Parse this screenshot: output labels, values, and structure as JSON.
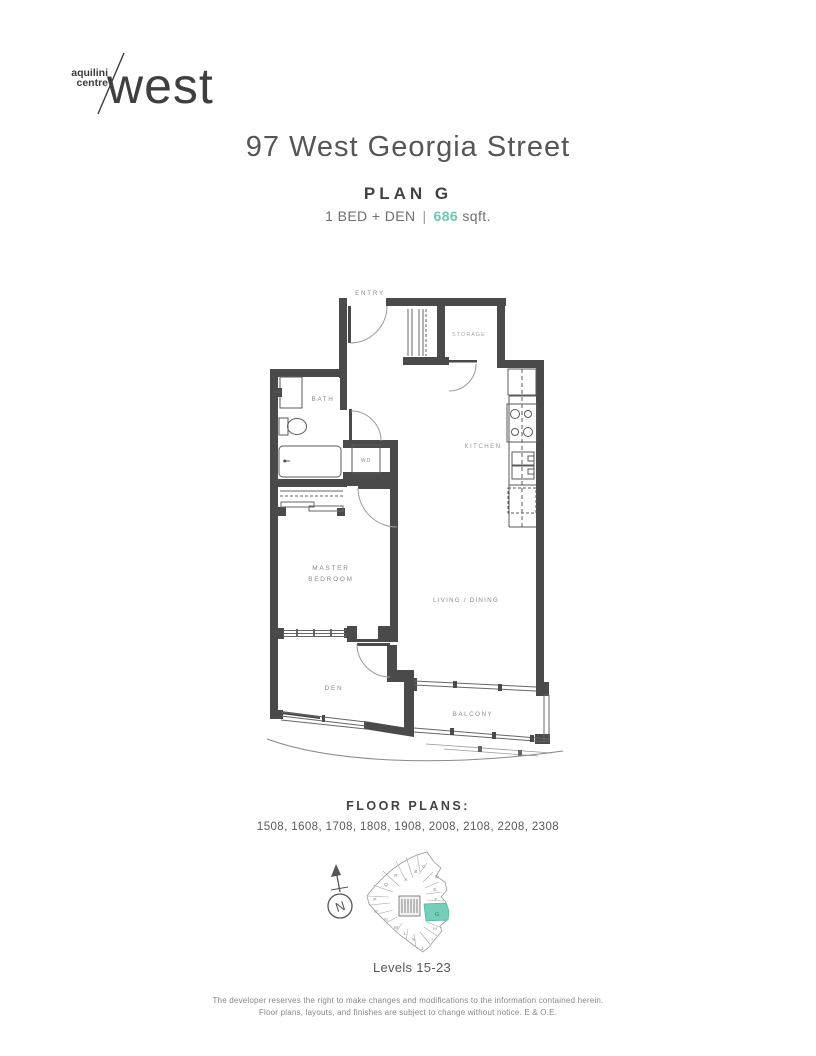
{
  "logo": {
    "line1": "aquilini",
    "line2": "centre",
    "name": "west"
  },
  "header": {
    "title": "97 West Georgia Street",
    "plan": "PLAN G",
    "bed": "1 BED + DEN",
    "sep": "|",
    "sqft_value": "686",
    "sqft_unit": "sqft."
  },
  "floorplan": {
    "labels": {
      "entry": "ENTRY",
      "storage": "STORAGE",
      "bath": "BATH",
      "wd": "WD",
      "kitchen": "KITCHEN",
      "master1": "MASTER",
      "master2": "BEDROOM",
      "living": "LIVING / DINING",
      "den": "DEN",
      "balcony": "BALCONY"
    }
  },
  "floors": {
    "heading": "FLOOR PLANS:",
    "list": "1508, 1608, 1708, 1808, 1908, 2008, 2108, 2208, 2308"
  },
  "sitemap": {
    "north": "N",
    "levels": "Levels 15-23",
    "highlight": "G",
    "units": [
      "C",
      "D",
      "E",
      "F",
      "H",
      "I",
      "J",
      "K",
      "L",
      "M",
      "N",
      "O",
      "P",
      "Q",
      "R",
      "A",
      "B"
    ]
  },
  "disclaimer": {
    "line1": "The developer reserves the right to make changes and modifications to the information contained herein.",
    "line2": "Floor plans, layouts, and finishes are subject to change without notice. E & O.E."
  },
  "colors": {
    "accent": "#69C9B1",
    "wall": "#4A4A4A",
    "highlight_fill": "#74CEB8"
  }
}
